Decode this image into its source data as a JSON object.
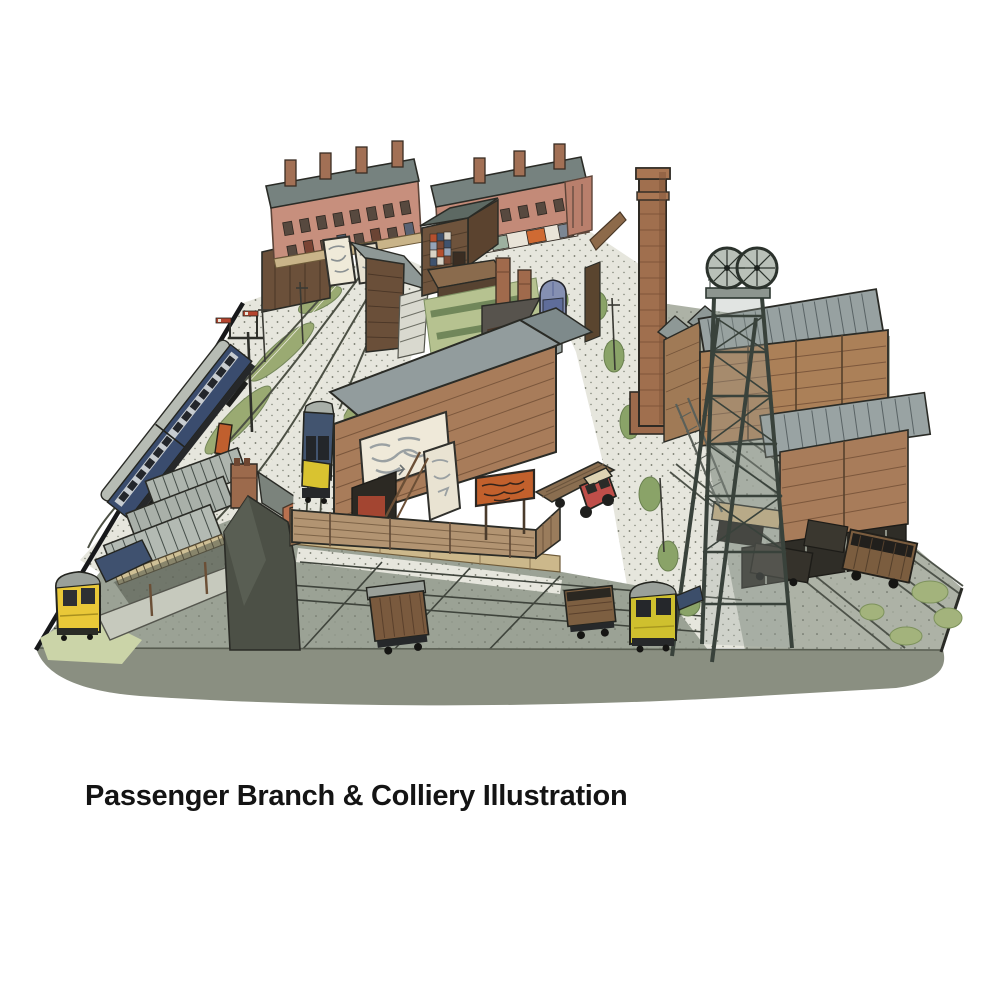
{
  "caption": {
    "text": "Passenger Branch & Colliery Illustration"
  },
  "illustration": {
    "alt": "Hand-drawn pen and watercolour bird's-eye illustration of a model railway layout: a canopied passenger branch terminus with a blue-and-grey coach and yellow-fronted DMUs on the left, terraced houses, shops, allotment gardens, sheds and billboards at the rear, a tall brick mill chimney in the middle, and a timber colliery with winding headgear wheels, screens building and coal wagons on sidings to the right; gravel roads with a red flatbed lorry and a blue van cross the scene.",
    "medium": "pen and watercolour",
    "features": [
      "terraced-houses",
      "shops-terrace",
      "gable-house",
      "billboards",
      "wooden-shed",
      "allotment-gardens",
      "tall-brick-chimney",
      "colliery-headframe",
      "winding-wheels",
      "screens-building",
      "coal-wagons",
      "station-canopy",
      "platform",
      "semaphore-signal",
      "blue-grey-coach",
      "yellow-front-dmu",
      "blue-box-van",
      "red-flatbed-lorry",
      "box-van-wagon",
      "open-wagon",
      "gravel-road",
      "sidings",
      "foreground-apron"
    ],
    "palette": {
      "paper": "#ffffff",
      "ink": "#23241f",
      "brick": "#c78f7d",
      "chimney_brick": "#a06f4e",
      "slate_roof": "#76827f",
      "corrugated_roof": "#97a1a1",
      "timber": "#a87c5a",
      "dark_timber": "#6a4f39",
      "gravel": "#e6e6dd",
      "tarmac": "#9ba295",
      "grass": "#9aaa72",
      "train_blue": "#3f516f",
      "warning_yellow": "#e9c838",
      "dmu_yellow_green": "#cfc02e",
      "sign_orange": "#c2602c",
      "lorry_red": "#bf4e49",
      "van_blue": "#8590b2"
    }
  }
}
